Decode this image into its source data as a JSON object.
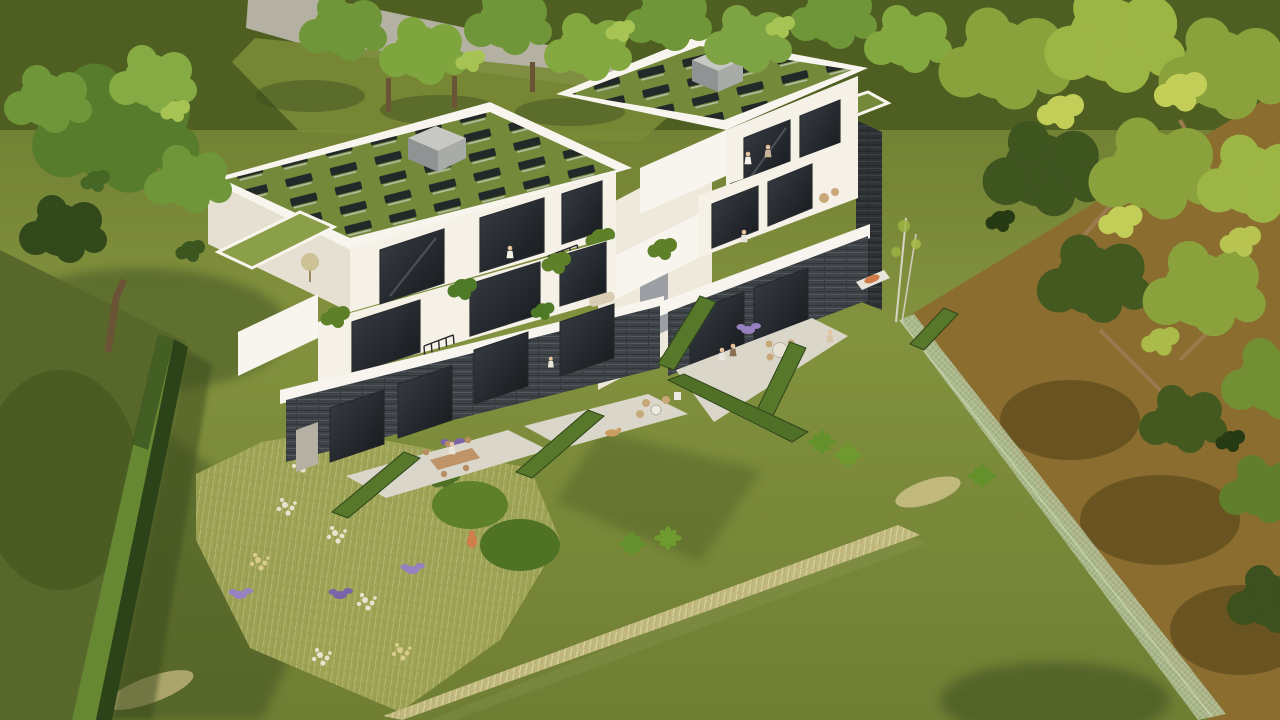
{
  "scene": {
    "description": "Aerial 3D architectural visualization of two modern white multi-family villas on a sloped garden plot, viewed from above at an angle, late-afternoon sun from the upper right",
    "sun_direction": "upper-right",
    "buildings": [
      {
        "name": "left-residence",
        "floors": 3,
        "roof": "extensive green roof with rows of tilted solar collectors",
        "rooftop_block": "grey roof-access cube",
        "solar_panels_approx": 30,
        "facade": "white plaster",
        "base": "dark slate stone with full-height glazing",
        "features": [
          "stepped terraces",
          "juliet balconies",
          "planters with shrubs",
          "grass setback roof",
          "two ground-floor patios with dining furniture"
        ]
      },
      {
        "name": "right-residence",
        "floors": 3,
        "roof": "extensive green roof with rows of tilted solar collectors",
        "rooftop_block": "grey roof-access cube",
        "solar_panels_approx": 20,
        "facade": "white plaster",
        "base": "dark slate stone with full-height glazing",
        "features": [
          "west-facing balconies",
          "slate side column",
          "patio with round dining table",
          "garden lounger with orange cushion"
        ]
      }
    ],
    "landscape": {
      "lawn": "large yellow-green meadow lawn in foreground",
      "flower_meadow": "triangular wildflower bed with white, yellow and lavender-purple blooms and green shrubs",
      "tall_grass_strip": "diagonal band of dry beige ornamental grass crossing the lawn",
      "hedges": [
        "tall dark boundary hedge on the left",
        "five clipped hedge dividers between private terraces",
        "long hedge along garden slope"
      ],
      "fence": "light sage mesh fence on the right boundary",
      "path": "grey footpath along the top street edge",
      "trees": [
        "large deciduous tree upper left",
        "row of street trees along the top",
        "dense yellow-green woodland canopy on the right",
        "two slender birches beside the right garden"
      ]
    },
    "people_count": 10,
    "people": [
      "balcony left roof level",
      "two on right upper balcony",
      "right middle balcony",
      "seated at left patio table",
      "child on right patio",
      "two walking between hedges",
      "walker on right lawn",
      "person at garden lounger"
    ],
    "animals": [
      "ginger cat on the lawn",
      "golden dog on the left patio"
    ],
    "furniture": [
      "rectangular wooden dining table with chairs",
      "round patio table with four chairs",
      "rattan lounge chairs",
      "beige garden sofa",
      "sun lounger with orange cushion",
      "white planter pots"
    ]
  },
  "palette": {
    "lawn_top": "#67762c",
    "lawn_mid": "#83923e",
    "lawn_bottom": "#6f7e33",
    "top_band": "#4f5f22",
    "path": "#b5b1a2",
    "earth": "#8a6d2f",
    "canopy_light": "#c2ce58",
    "canopy_mid": "#8ba23c",
    "canopy_dark": "#3f5520",
    "canopy_deep": "#263a14",
    "branch": "#9a7b4e",
    "tree_green_mid": "#6f9638",
    "tree_green_light": "#a6c354",
    "tree_green_dark": "#32491b",
    "trunk": "#6b5336",
    "roof_grass": "#75893a",
    "roof_grass_light": "#8b9e48",
    "parapet": "#f8f5ee",
    "wall_bright": "#f5f1e7",
    "wall_shade": "#e6e0d2",
    "slate": "#3e4347",
    "slate_light": "#585e63",
    "glass_dark": "#16191c",
    "glass_light": "#383e45",
    "block_top": "#c7c8c4",
    "block_side": "#8f9394",
    "block_side2": "#a9aba9",
    "terrace": "#dad7ca",
    "table_wood": "#bf9468",
    "rattan": "#c8a878",
    "hedge_dark": "#2c4218",
    "hedge_lit": "#678833",
    "divider_hedge": "#57782b",
    "meadow_base": "#9da253",
    "flower_white": "#e8e4d0",
    "flower_yellow": "#d9cd8c",
    "lavender": "#9781c0",
    "purple": "#7b64a8",
    "dry_grass": "#c1b87e",
    "dry_grass_light": "#ddd6a4",
    "fence": "#a9b98f",
    "fern": "#64912c",
    "shadow": "#243415",
    "orange_cushion": "#d07b45",
    "dog_fur": "#c99f5e",
    "cat_fur": "#cf7f4a",
    "skin": "#e9c59e",
    "sofa": "#d9cdb4",
    "door_gray": "#b4b0a4",
    "core_gray": "#9b9ea2"
  }
}
